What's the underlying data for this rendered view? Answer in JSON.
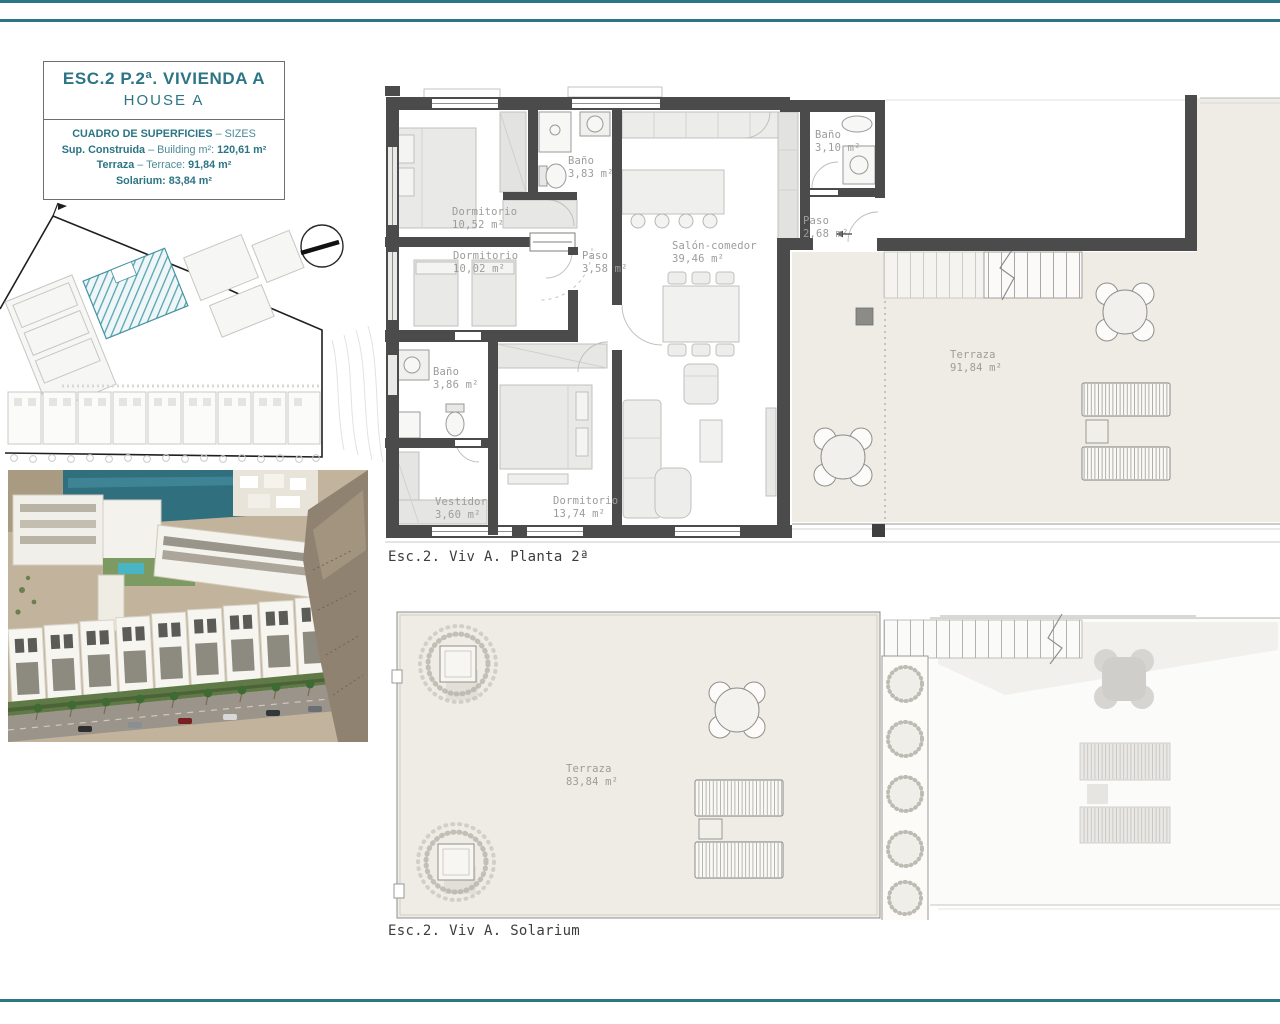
{
  "colors": {
    "accent": "#2b7585",
    "site_highlight": "#57a3b2",
    "wall": "#4b4b4b",
    "terrace_floor": "#efebe5"
  },
  "title_block": {
    "title": "ESC.2 P.2ª. VIVIENDA A",
    "subtitle": "HOUSE A",
    "table_title": "CUADRO DE SUPERFICIES",
    "table_title_suffix": "– SIZES",
    "rows": [
      {
        "label": "Sup. Construida",
        "mid": "– Building m²:",
        "value": "120,61 m²"
      },
      {
        "label": "Terraza",
        "mid": "– Terrace:",
        "value": "91,84 m²"
      },
      {
        "label": "Solarium:",
        "mid": "",
        "value": "83,84 m²"
      }
    ]
  },
  "plans": {
    "planta2": {
      "caption": "Esc.2. Viv A. Planta 2ª",
      "rooms": [
        {
          "name": "Dormitorio",
          "area": "10,52 m²"
        },
        {
          "name": "Baño",
          "area": "3,83 m²"
        },
        {
          "name": "Dormitorio",
          "area": "10,02 m²"
        },
        {
          "name": "Paso",
          "area": "3,58 m²"
        },
        {
          "name": "Salón-comedor",
          "area": "39,46 m²"
        },
        {
          "name": "Baño",
          "area": "3,10 m²"
        },
        {
          "name": "Paso",
          "area": "2,68 m²"
        },
        {
          "name": "Baño",
          "area": "3,86 m²"
        },
        {
          "name": "Vestidor",
          "area": "3,60 m²"
        },
        {
          "name": "Dormitorio",
          "area": "13,74 m²"
        },
        {
          "name": "Terraza",
          "area": "91,84 m²"
        }
      ]
    },
    "solarium": {
      "caption": "Esc.2. Viv A. Solarium",
      "rooms": [
        {
          "name": "Terraza",
          "area": "83,84 m²"
        }
      ]
    }
  }
}
